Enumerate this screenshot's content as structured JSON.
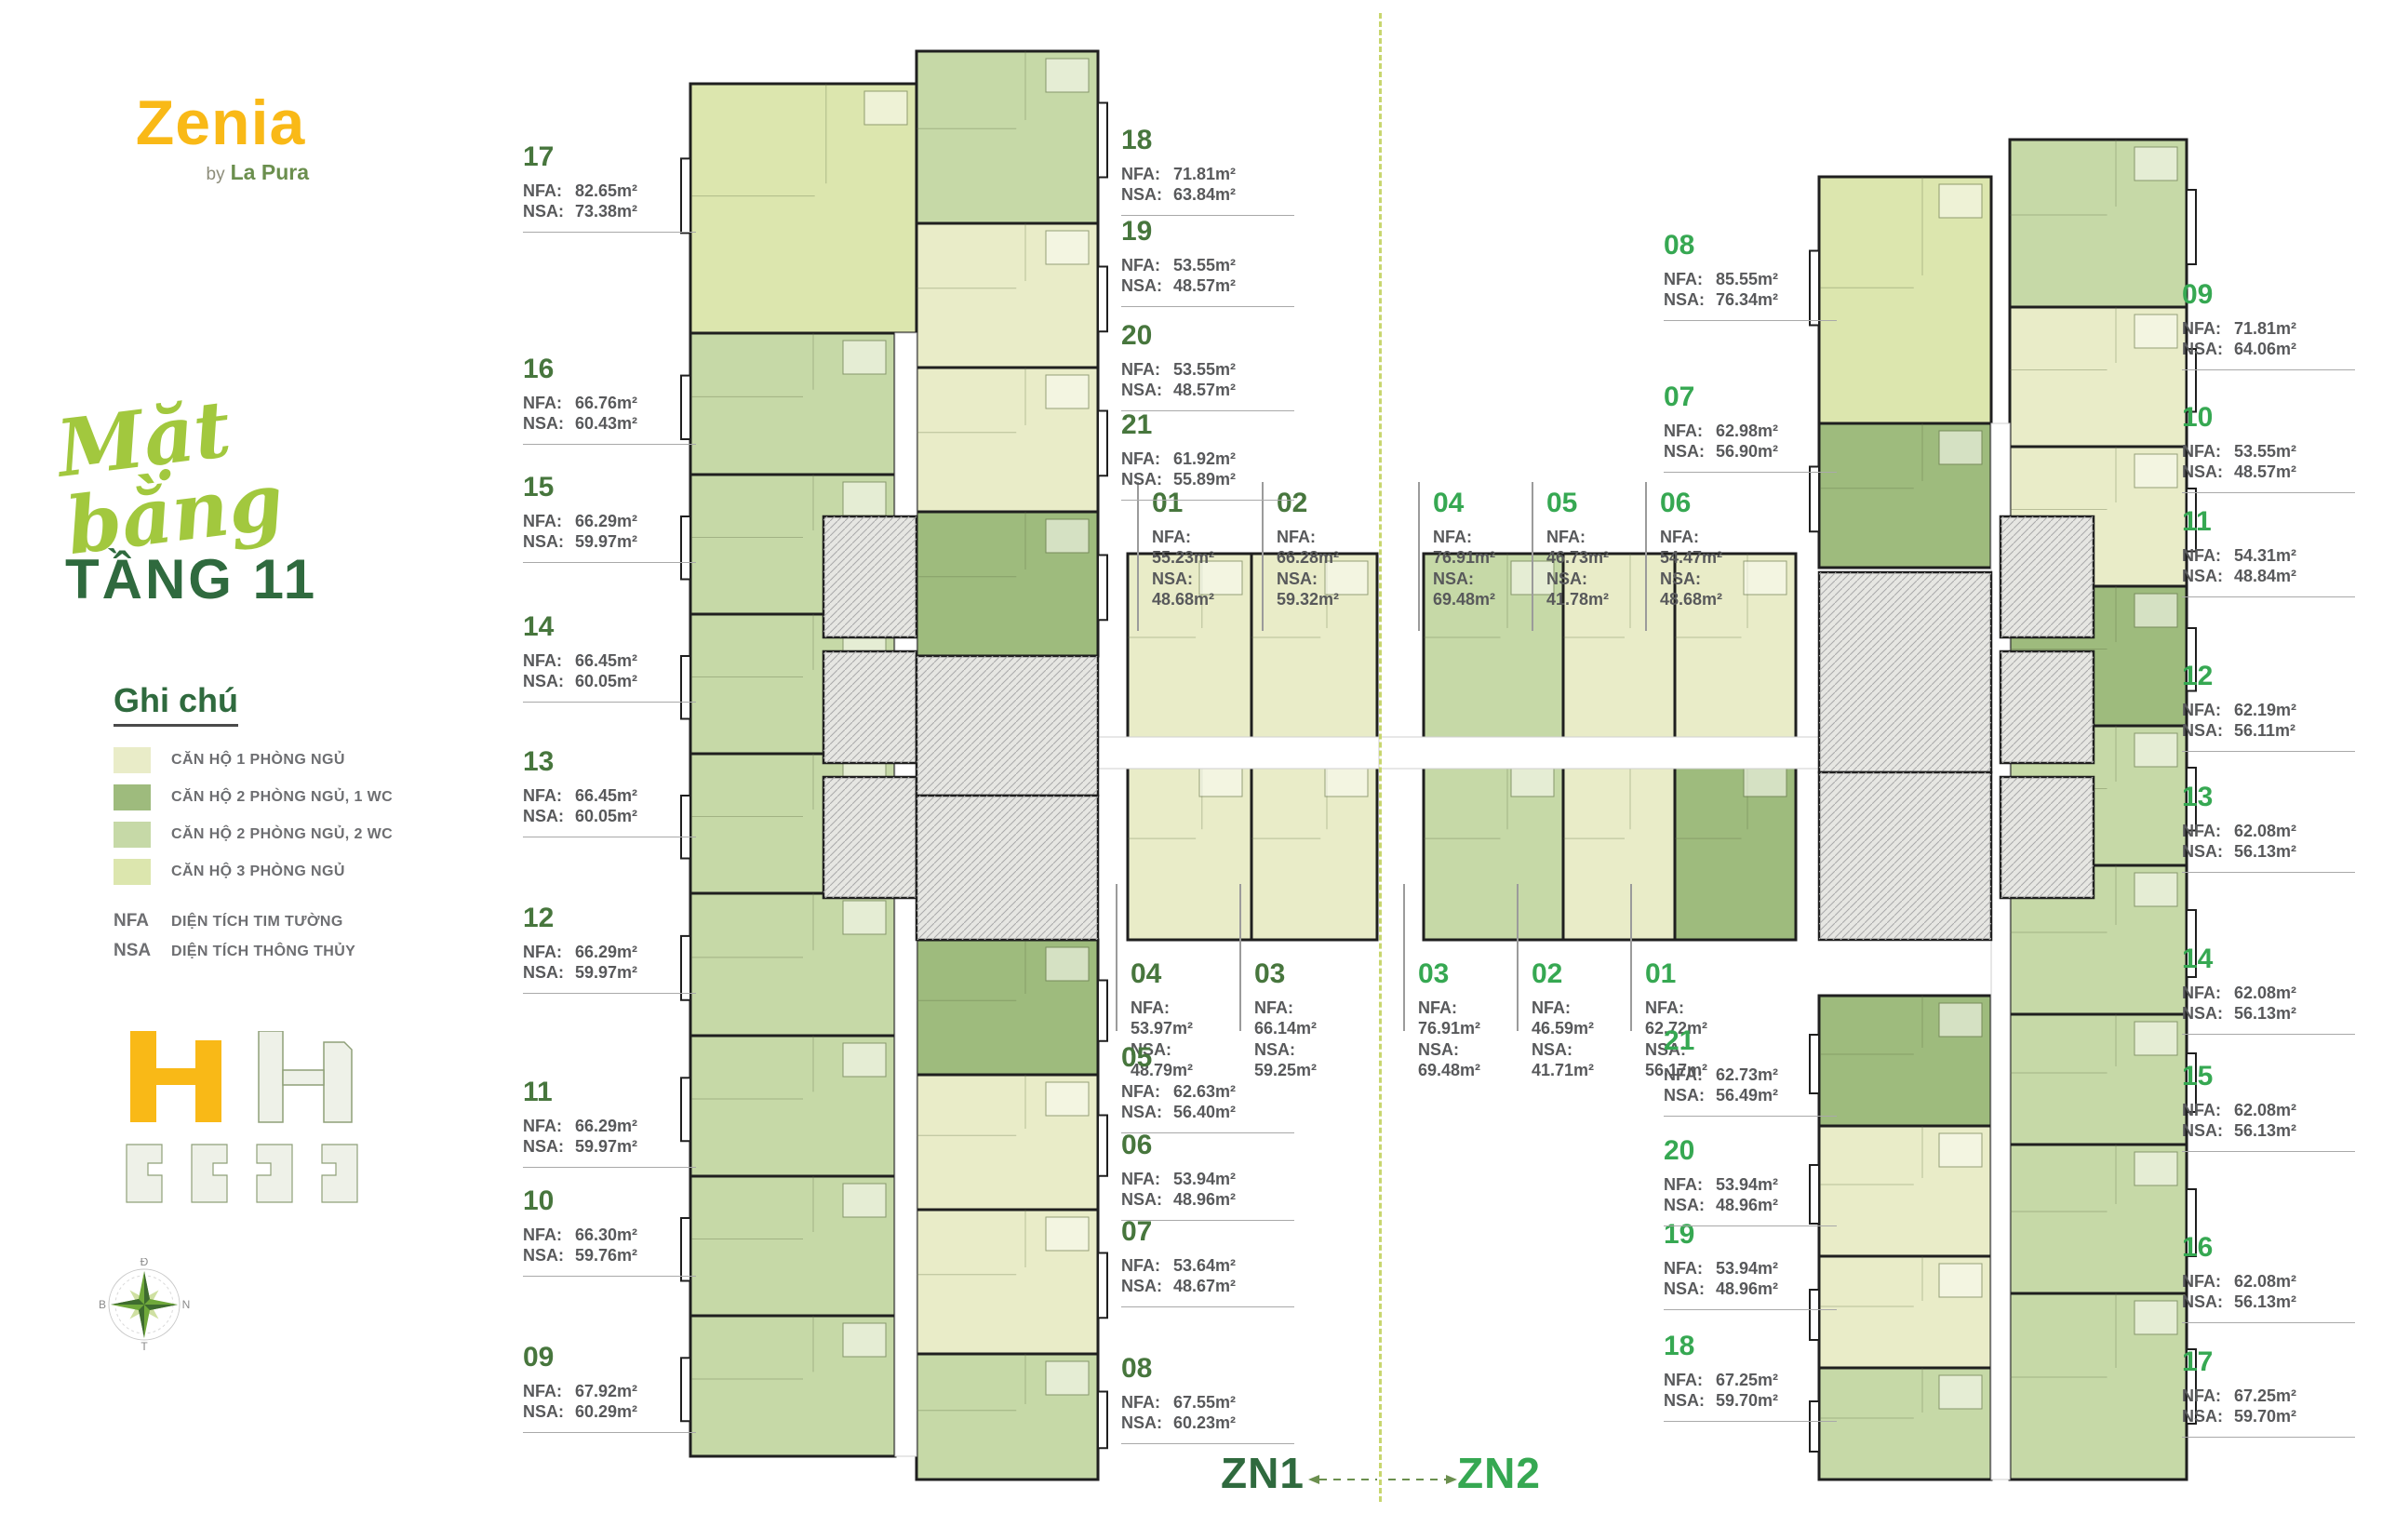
{
  "branding": {
    "logo": "Zenia",
    "byline_prefix": "by",
    "byline_brand": "La Pura"
  },
  "title": {
    "script": "Mặt bằng",
    "floor": "TẦNG 11"
  },
  "legend": {
    "heading": "Ghi chú",
    "items": [
      {
        "key": "1br",
        "label": "CĂN HỘ 1 PHÒNG NGỦ",
        "color": "#E9ECC8"
      },
      {
        "key": "2br1wc",
        "label": "CĂN HỘ 2 PHÒNG NGỦ, 1 WC",
        "color": "#9EBB7D"
      },
      {
        "key": "2br2wc",
        "label": "CĂN HỘ 2 PHÒNG NGỦ, 2 WC",
        "color": "#C6D9A7"
      },
      {
        "key": "3br",
        "label": "CĂN HỘ 3 PHÒNG NGỦ",
        "color": "#DCE6AE"
      }
    ],
    "abbreviations": [
      {
        "abbr": "NFA",
        "label": "DIỆN TÍCH TIM TƯỜNG"
      },
      {
        "abbr": "NSA",
        "label": "DIỆN TÍCH THÔNG THỦY"
      }
    ]
  },
  "field_labels": {
    "nfa": "NFA:",
    "nsa": "NSA:"
  },
  "compass": {
    "top": "Đ",
    "right": "N",
    "bottom": "T",
    "left": "B"
  },
  "colors": {
    "logo_yellow": "#F9B917",
    "brand_green": "#6B8F4E",
    "script_green": "#A2C83E",
    "heading_green": "#2F6A3E",
    "zn1_number": "#47763D",
    "zn2_number": "#36A852",
    "divider": "#C8D66E",
    "wall": "#1f1f1f"
  },
  "zones": [
    {
      "id": "ZN1",
      "label": "ZN1",
      "units": [
        {
          "id": "01",
          "nfa": "55.23m²",
          "nsa": "48.68m²",
          "type": "1br"
        },
        {
          "id": "02",
          "nfa": "66.28m²",
          "nsa": "59.32m²",
          "type": "1br"
        },
        {
          "id": "03",
          "nfa": "66.14m²",
          "nsa": "59.25m²",
          "type": "1br"
        },
        {
          "id": "04",
          "nfa": "53.97m²",
          "nsa": "48.79m²",
          "type": "1br"
        },
        {
          "id": "05",
          "nfa": "62.63m²",
          "nsa": "56.40m²",
          "type": "2br1wc"
        },
        {
          "id": "06",
          "nfa": "53.94m²",
          "nsa": "48.96m²",
          "type": "1br"
        },
        {
          "id": "07",
          "nfa": "53.64m²",
          "nsa": "48.67m²",
          "type": "1br"
        },
        {
          "id": "08",
          "nfa": "67.55m²",
          "nsa": "60.23m²",
          "type": "2br2wc"
        },
        {
          "id": "09",
          "nfa": "67.92m²",
          "nsa": "60.29m²",
          "type": "2br2wc"
        },
        {
          "id": "10",
          "nfa": "66.30m²",
          "nsa": "59.76m²",
          "type": "2br2wc"
        },
        {
          "id": "11",
          "nfa": "66.29m²",
          "nsa": "59.97m²",
          "type": "2br2wc"
        },
        {
          "id": "12",
          "nfa": "66.29m²",
          "nsa": "59.97m²",
          "type": "2br2wc"
        },
        {
          "id": "13",
          "nfa": "66.45m²",
          "nsa": "60.05m²",
          "type": "2br2wc"
        },
        {
          "id": "14",
          "nfa": "66.45m²",
          "nsa": "60.05m²",
          "type": "2br2wc"
        },
        {
          "id": "15",
          "nfa": "66.29m²",
          "nsa": "59.97m²",
          "type": "2br2wc"
        },
        {
          "id": "16",
          "nfa": "66.76m²",
          "nsa": "60.43m²",
          "type": "2br2wc"
        },
        {
          "id": "17",
          "nfa": "82.65m²",
          "nsa": "73.38m²",
          "type": "3br"
        },
        {
          "id": "18",
          "nfa": "71.81m²",
          "nsa": "63.84m²",
          "type": "2br2wc"
        },
        {
          "id": "19",
          "nfa": "53.55m²",
          "nsa": "48.57m²",
          "type": "1br"
        },
        {
          "id": "20",
          "nfa": "53.55m²",
          "nsa": "48.57m²",
          "type": "1br"
        },
        {
          "id": "21",
          "nfa": "61.92m²",
          "nsa": "55.89m²",
          "type": "2br1wc"
        }
      ]
    },
    {
      "id": "ZN2",
      "label": "ZN2",
      "units": [
        {
          "id": "01",
          "nfa": "62.72m²",
          "nsa": "56.17m²",
          "type": "2br1wc"
        },
        {
          "id": "02",
          "nfa": "46.59m²",
          "nsa": "41.71m²",
          "type": "1br"
        },
        {
          "id": "03",
          "nfa": "76.91m²",
          "nsa": "69.48m²",
          "type": "2br2wc"
        },
        {
          "id": "04",
          "nfa": "76.91m²",
          "nsa": "69.48m²",
          "type": "2br2wc"
        },
        {
          "id": "05",
          "nfa": "46.73m²",
          "nsa": "41.78m²",
          "type": "1br"
        },
        {
          "id": "06",
          "nfa": "54.47m²",
          "nsa": "48.68m²",
          "type": "1br"
        },
        {
          "id": "07",
          "nfa": "62.98m²",
          "nsa": "56.90m²",
          "type": "2br1wc"
        },
        {
          "id": "08",
          "nfa": "85.55m²",
          "nsa": "76.34m²",
          "type": "3br"
        },
        {
          "id": "09",
          "nfa": "71.81m²",
          "nsa": "64.06m²",
          "type": "2br2wc"
        },
        {
          "id": "10",
          "nfa": "53.55m²",
          "nsa": "48.57m²",
          "type": "1br"
        },
        {
          "id": "11",
          "nfa": "54.31m²",
          "nsa": "48.84m²",
          "type": "1br"
        },
        {
          "id": "12",
          "nfa": "62.19m²",
          "nsa": "56.11m²",
          "type": "2br1wc"
        },
        {
          "id": "13",
          "nfa": "62.08m²",
          "nsa": "56.13m²",
          "type": "2br2wc"
        },
        {
          "id": "14",
          "nfa": "62.08m²",
          "nsa": "56.13m²",
          "type": "2br2wc"
        },
        {
          "id": "15",
          "nfa": "62.08m²",
          "nsa": "56.13m²",
          "type": "2br2wc"
        },
        {
          "id": "16",
          "nfa": "62.08m²",
          "nsa": "56.13m²",
          "type": "2br2wc"
        },
        {
          "id": "17",
          "nfa": "67.25m²",
          "nsa": "59.70m²",
          "type": "2br2wc"
        },
        {
          "id": "18",
          "nfa": "67.25m²",
          "nsa": "59.70m²",
          "type": "2br2wc"
        },
        {
          "id": "19",
          "nfa": "53.94m²",
          "nsa": "48.96m²",
          "type": "1br"
        },
        {
          "id": "20",
          "nfa": "53.94m²",
          "nsa": "48.96m²",
          "type": "1br"
        },
        {
          "id": "21",
          "nfa": "62.73m²",
          "nsa": "56.49m²",
          "type": "2br1wc"
        }
      ]
    }
  ],
  "footer": {
    "zn1": "ZN1",
    "zn2": "ZN2"
  }
}
